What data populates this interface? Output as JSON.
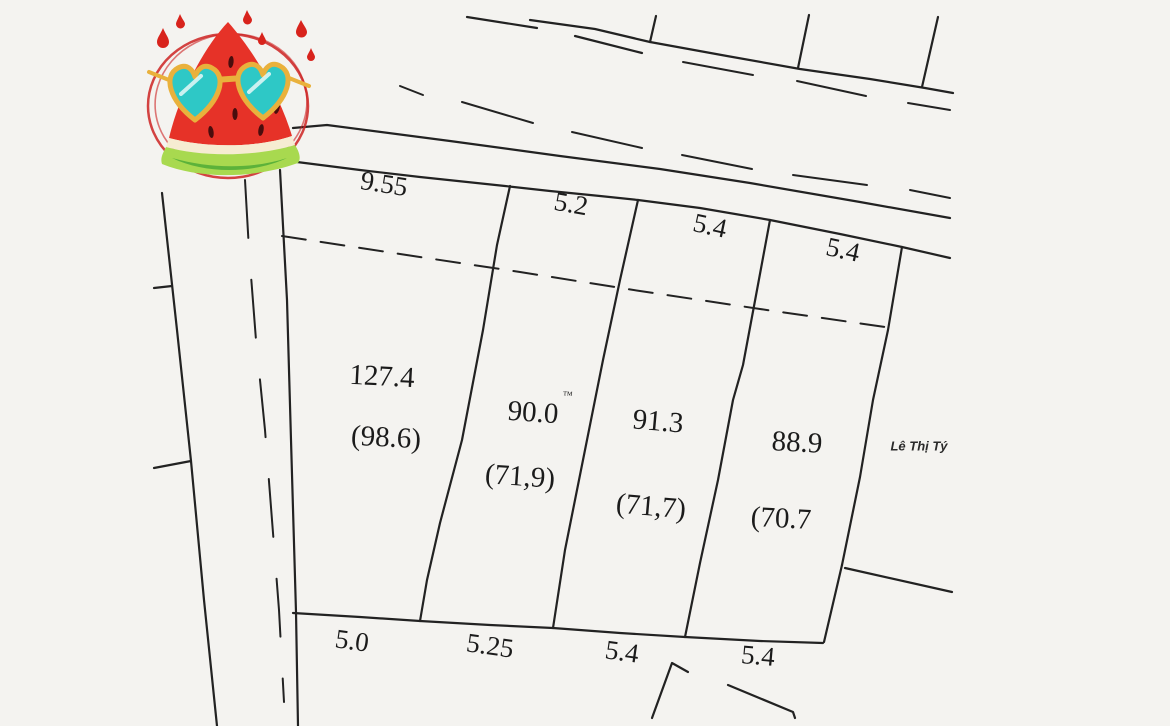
{
  "drawing": {
    "type": "cadastral-parcel-sketch",
    "parcels": [
      {
        "area": "127.4",
        "area_alt": "(98.6)",
        "top_frontage": "9.55",
        "bottom_frontage": "5.0"
      },
      {
        "area": "90.0",
        "area_superscript": "™",
        "area_alt": "(71,9)",
        "top_frontage": "5.2",
        "bottom_frontage": "5.25"
      },
      {
        "area": "91.3",
        "area_alt": "(71,7)",
        "top_frontage": "5.4",
        "bottom_frontage": "5.4"
      },
      {
        "area": "88.9",
        "area_alt": "(70.7",
        "top_frontage": "5.4",
        "bottom_frontage": "5.4"
      }
    ],
    "neighbor_label": "Lê Thị Tý",
    "sticker": "watermelon-with-heart-sunglasses",
    "line_color": "#222222",
    "background": "#f4f3f0",
    "sticker_colors": {
      "flesh": "#e63228",
      "rind_light": "#a8d94f",
      "rind_dark": "#5cb23a",
      "lens": "#2ec8c6",
      "frame": "#e9b13c",
      "scribble": "#cc2222"
    }
  }
}
